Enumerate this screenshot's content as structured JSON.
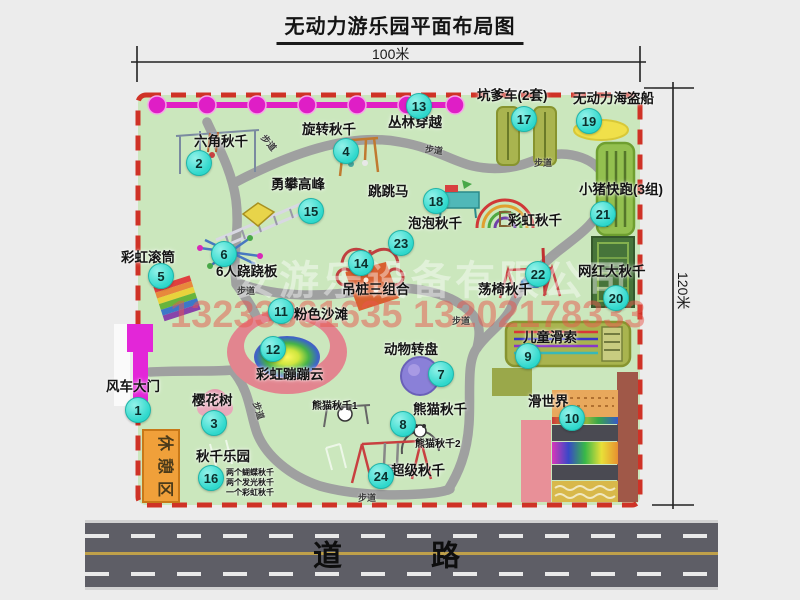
{
  "title": "无动力游乐园平面布局图",
  "dimensions": {
    "top": "100米",
    "right": "120米"
  },
  "watermark": {
    "company": "安游乐设备有限公司",
    "phone": "13233861635 13202178333"
  },
  "road": {
    "label": "道　路"
  },
  "path_label": "步道",
  "extras": {
    "rainbow_swing": "彩虹秋千",
    "rest_area": "休憩区",
    "panda_1": "熊猫秋千1",
    "panda_2": "熊猫秋千2"
  },
  "attractions": [
    {
      "num": "1",
      "label": "风车大门"
    },
    {
      "num": "2",
      "label": "六角秋千"
    },
    {
      "num": "3",
      "label": "樱花树"
    },
    {
      "num": "4",
      "label": "旋转秋千"
    },
    {
      "num": "5",
      "label": "彩虹滚筒"
    },
    {
      "num": "6",
      "label": "6人跷跷板"
    },
    {
      "num": "7",
      "label": "动物转盘"
    },
    {
      "num": "8",
      "label": "熊猫秋千"
    },
    {
      "num": "9",
      "label": "儿童滑索"
    },
    {
      "num": "10",
      "label": "滑世界"
    },
    {
      "num": "11",
      "label": "粉色沙滩"
    },
    {
      "num": "12",
      "label": "彩虹蹦蹦云"
    },
    {
      "num": "13",
      "label": "丛林穿越"
    },
    {
      "num": "14",
      "label": "吊桩三组合"
    },
    {
      "num": "15",
      "label": "勇攀高峰"
    },
    {
      "num": "16",
      "label": "秋千乐园",
      "notes": [
        "两个蝴蝶秋千",
        "两个发光秋千",
        "一个彩虹秋千"
      ]
    },
    {
      "num": "17",
      "label": "坑爹车(2套)"
    },
    {
      "num": "18",
      "label": "跳跳马"
    },
    {
      "num": "19",
      "label": "无动力海盗船"
    },
    {
      "num": "20",
      "label": "网红大秋千"
    },
    {
      "num": "21",
      "label": "小猪快跑(3组)"
    },
    {
      "num": "22",
      "label": "荡椅秋千"
    },
    {
      "num": "23",
      "label": "泡泡秋千"
    },
    {
      "num": "24",
      "label": "超级秋千"
    }
  ],
  "colors": {
    "park_green": "#cbe7bd",
    "border_red": "#cf3226",
    "badge_cyan": "#2ed8cc",
    "zipline_magenta": "#e11fc4",
    "road_gray": "#5e5e66",
    "gate_magenta": "#e326d8",
    "rest_orange": "#f0a03a"
  }
}
